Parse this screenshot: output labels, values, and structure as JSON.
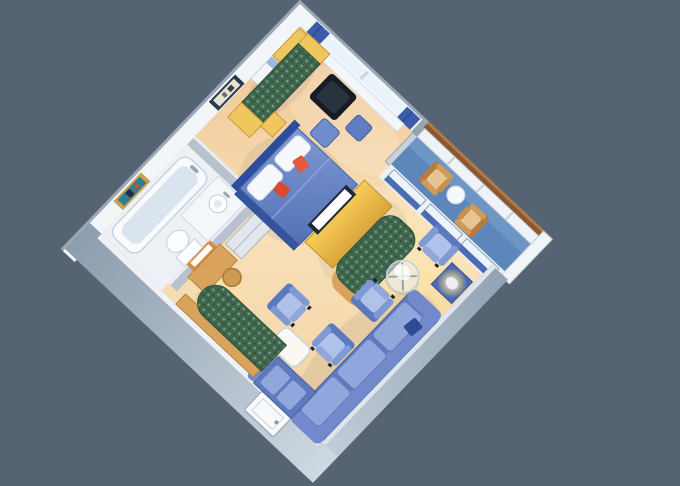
{
  "scene": {
    "type": "3d-isometric-floor-plan",
    "subject": "cruise-ship-suite-with-private-balcony",
    "rooms": [
      "bedroom",
      "bathroom",
      "entry-hall",
      "sitting-area",
      "private-balcony"
    ],
    "furniture": [
      "double-bed",
      "headboard",
      "bed-pillows",
      "accent-pillows",
      "nightstand",
      "corner-cabinet",
      "luggage-bench",
      "window-bench",
      "green-daybed-sofa",
      "daybed-end-tables",
      "black-coffee-table",
      "blue-ottomans",
      "wall-art-bedroom",
      "tv-cabinet",
      "television",
      "curved-media-sofa",
      "armchairs",
      "round-glass-table",
      "side-table-with-lamp",
      "sectional-sofa",
      "sofa-chaise-return",
      "white-coffee-table",
      "curved-green-bench",
      "bathtub",
      "sink-vanity",
      "toilet",
      "wall-art-bathroom",
      "closet",
      "vanity-desk",
      "vanity-mirror",
      "vanity-stool",
      "balcony-chairs",
      "balcony-side-table",
      "balcony-railing",
      "sliding-glass-doors",
      "entry-door"
    ],
    "colors": {
      "background": "#566372",
      "wall_white": "#F3F6F9",
      "wall_rim": "#C3CED8",
      "wall_gray": "#B7C2CE",
      "wall_top": "#E9EEF3",
      "column_gray": "#96A4B2",
      "column_face": "#C9D2DA",
      "floor_balcony": "#5D87BB",
      "floor_bath": "#EDF1F6",
      "rail_wood": "#8A5830",
      "rail_wood_light": "#B5804C",
      "rail_panel": "#EFF3F7",
      "curtain_blue": "#3C5CAA",
      "window_glass": "#E9F3FB",
      "sill_white": "#F3F6FA",
      "door_panel_blue": "#4A6CB2",
      "bed_dark_side": "#35549E",
      "headboard_blue": "#2E4C9C",
      "pillow_white": "#F6F8FB",
      "pillow_orange": "#E2593C",
      "pillow_orange_2": "#D84A2E",
      "wood_yellow": "#EFC75E",
      "wood_tan": "#D9A35E",
      "table_black": "#161C26",
      "table_black_top": "#2A323E",
      "ottoman_blue": "#5F7DC0",
      "ottoman_blue_2": "#6F8CCB",
      "tv_frame": "#1E2836",
      "tv_screen": "#FFFFFF",
      "sofa_base": "#5F79BE",
      "sofa_back": "#7289CC",
      "sofa_cushion": "#91A7DC",
      "sofa_pillow_navy": "#2E4A96",
      "lamp_table_blue": "#4A68B0",
      "lamp_shade": "#EDEFF2",
      "closet_front": "#E2E7EE",
      "tub_white": "#F8FAFC",
      "tub_inner": "#D9E4EF",
      "fixture_white": "#FBFDFE",
      "vanity_mirror_frame": "#D98B3F",
      "stool_tan": "#CC9A52",
      "art1_frame": "#2A3850",
      "art1_mat": "#E8E4D4",
      "art2_frame": "#C9A14F",
      "art2_teal": "#2E7E90",
      "art2_red": "#D84A30",
      "entry_door": "#F7F9FB",
      "balcony_table_white": "#F6F9FB"
    }
  }
}
